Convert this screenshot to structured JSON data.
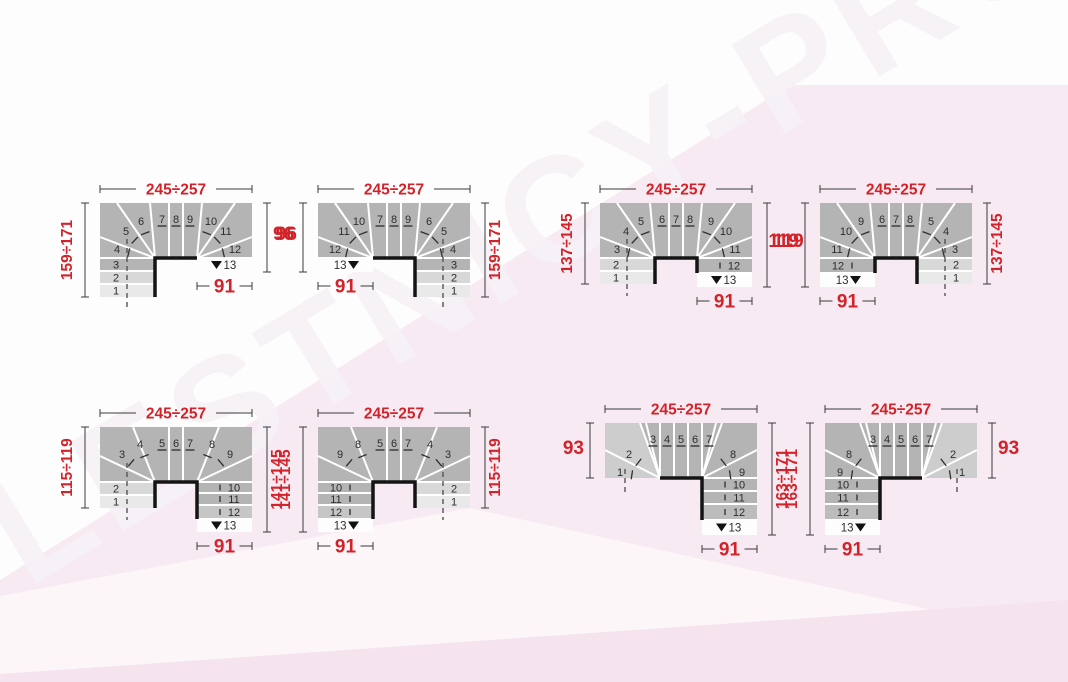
{
  "watermark": "LESTNICY-PROSTO.RU",
  "colors": {
    "red": "#d2232a",
    "body_gray": "#b4b4b4",
    "light_step1": "#d8d8d8",
    "light_step2": "#e9e9e9",
    "light_wedge": "#cdcdcd",
    "last_row": "#fdfdfe",
    "dim_line": "#3a3a3a",
    "step_number": "#2d2d2d",
    "well_line": "#141414",
    "divider": "#ffffff"
  },
  "diagrams": [
    {
      "name": "winder-stair-u-right",
      "mirror": false,
      "variant": "A",
      "dims": {
        "top": "245÷257",
        "left": "159÷171",
        "right": "96",
        "bottom": "91"
      },
      "steps": {
        "entry_column": [
          "3",
          "2",
          "1"
        ],
        "winder_in": [
          "4",
          "5",
          "6"
        ],
        "straight": [
          "7",
          "8",
          "9"
        ],
        "winder_out": [
          "10",
          "11",
          "12"
        ],
        "exit_column": [],
        "last": "13"
      }
    },
    {
      "name": "winder-stair-u-left",
      "mirror": true,
      "variant": "A",
      "dims": {
        "top": "245÷257",
        "left": "96",
        "right": "159÷171",
        "bottom": "91"
      },
      "steps": {
        "entry_column": [
          "3",
          "2",
          "1"
        ],
        "winder_in": [
          "4",
          "5",
          "6"
        ],
        "straight": [
          "7",
          "8",
          "9"
        ],
        "winder_out": [
          "10",
          "11",
          "12"
        ],
        "exit_column": [],
        "last": "13"
      }
    },
    {
      "name": "winder-stair-u-right-deep-exit",
      "mirror": false,
      "variant": "B",
      "dims": {
        "top": "245÷257",
        "left": "137÷145",
        "right": "119",
        "bottom": "91"
      },
      "steps": {
        "entry_column": [
          "2",
          "1"
        ],
        "winder_in": [
          "3",
          "4",
          "5"
        ],
        "straight": [
          "6",
          "7",
          "8"
        ],
        "winder_out": [
          "9",
          "10",
          "11"
        ],
        "exit_column": [
          "12"
        ],
        "last": "13"
      }
    },
    {
      "name": "winder-stair-u-left-deep-exit",
      "mirror": true,
      "variant": "B",
      "dims": {
        "top": "245÷257",
        "left": "119",
        "right": "137÷145",
        "bottom": "91"
      },
      "steps": {
        "entry_column": [
          "2",
          "1"
        ],
        "winder_in": [
          "3",
          "4",
          "5"
        ],
        "straight": [
          "6",
          "7",
          "8"
        ],
        "winder_out": [
          "9",
          "10",
          "11"
        ],
        "exit_column": [
          "12"
        ],
        "last": "13"
      }
    },
    {
      "name": "winder-stair-u-right-long-exit",
      "mirror": false,
      "variant": "C",
      "dims": {
        "top": "245÷257",
        "left": "115÷119",
        "right": "141÷145",
        "bottom": "91"
      },
      "steps": {
        "entry_column": [
          "2",
          "1"
        ],
        "winder_in": [
          "3",
          "4"
        ],
        "straight": [
          "5",
          "6",
          "7"
        ],
        "winder_out": [
          "8",
          "9"
        ],
        "exit_column": [
          "10",
          "11",
          "12"
        ],
        "last": "13"
      }
    },
    {
      "name": "winder-stair-u-left-long-exit",
      "mirror": true,
      "variant": "C",
      "dims": {
        "top": "245÷257",
        "left": "141÷145",
        "right": "115÷119",
        "bottom": "91"
      },
      "steps": {
        "entry_column": [
          "2",
          "1"
        ],
        "winder_in": [
          "3",
          "4"
        ],
        "straight": [
          "5",
          "6",
          "7"
        ],
        "winder_out": [
          "8",
          "9"
        ],
        "exit_column": [
          "10",
          "11",
          "12"
        ],
        "last": "13"
      }
    },
    {
      "name": "winder-stair-l-right",
      "mirror": false,
      "variant": "D",
      "dims": {
        "top": "245÷257",
        "left": "93",
        "right": "163÷171",
        "bottom": "91"
      },
      "steps": {
        "entry_column": [],
        "winder_in": [
          "1",
          "2"
        ],
        "straight": [
          "3",
          "4",
          "5",
          "6",
          "7"
        ],
        "winder_out": [
          "8",
          "9"
        ],
        "exit_column": [
          "10",
          "11",
          "12"
        ],
        "last": "13"
      }
    },
    {
      "name": "winder-stair-l-left",
      "mirror": true,
      "variant": "D",
      "dims": {
        "top": "245÷257",
        "left": "163÷171",
        "right": "93",
        "bottom": "91"
      },
      "steps": {
        "entry_column": [],
        "winder_in": [
          "1",
          "2"
        ],
        "straight": [
          "3",
          "4",
          "5",
          "6",
          "7"
        ],
        "winder_out": [
          "8",
          "9"
        ],
        "exit_column": [
          "10",
          "11",
          "12"
        ],
        "last": "13"
      }
    }
  ]
}
